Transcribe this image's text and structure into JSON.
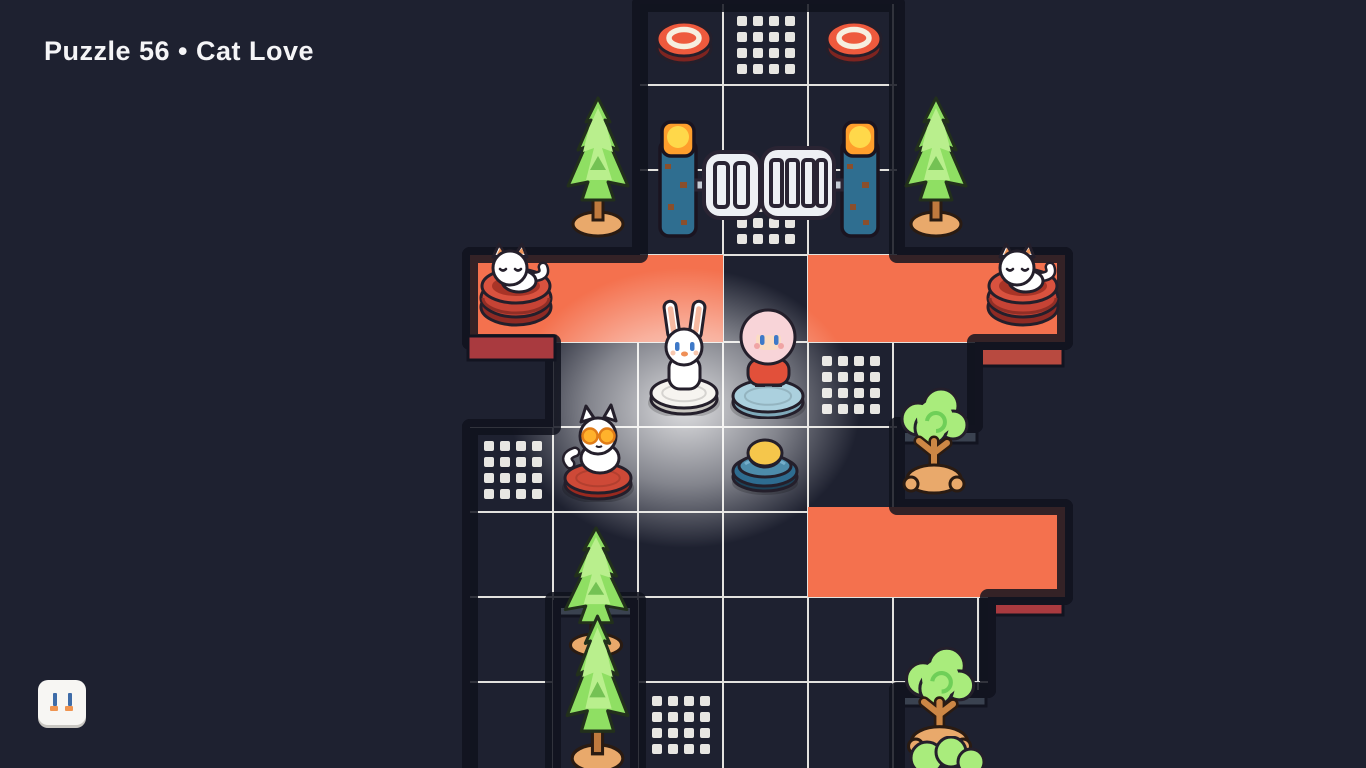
{
  "header": {
    "title": "Puzzle 56 • Cat Love"
  },
  "hud": {
    "pause_button": {
      "icon": "pause-icon"
    }
  },
  "colors": {
    "background": "#1e2130",
    "title_text": "#f5f5f7",
    "floor": "#f1f0ee",
    "floor_grid_line": "#e3e2de",
    "floor_dot": "#e7e6e2",
    "carpet_orange": "#f4714e",
    "carpet_side_red": "#a93a3f",
    "pipe_outline": "#121420",
    "pipe_silver": "#b8bfca",
    "pipe_highlight": "#e6e9ee",
    "under_floor_shade": "#3a4250",
    "glow_white": "#ffffff"
  },
  "board": {
    "carpets": [
      {
        "x": 470,
        "y": 255,
        "w": 253,
        "h": 87
      },
      {
        "x": 808,
        "y": 255,
        "w": 257,
        "h": 87
      },
      {
        "x": 808,
        "y": 507,
        "w": 257,
        "h": 90
      }
    ],
    "dotted_tiles": [
      {
        "x": 723,
        "y": 2
      },
      {
        "x": 723,
        "y": 172
      },
      {
        "x": 808,
        "y": 342
      },
      {
        "x": 470,
        "y": 427
      },
      {
        "x": 638,
        "y": 682
      }
    ]
  },
  "entities": [
    {
      "type": "pressure-plate",
      "name": "red-pressure-plate",
      "x": 653,
      "y": 12,
      "w": 62,
      "h": 56,
      "interactable": false
    },
    {
      "type": "pressure-plate",
      "name": "red-pressure-plate",
      "x": 823,
      "y": 12,
      "w": 62,
      "h": 56,
      "interactable": false
    },
    {
      "type": "pine-tree",
      "name": "pine-tree",
      "x": 556,
      "y": 96,
      "w": 84,
      "h": 142,
      "interactable": false
    },
    {
      "type": "pine-tree",
      "name": "pine-tree",
      "x": 894,
      "y": 96,
      "w": 84,
      "h": 142,
      "interactable": false
    },
    {
      "type": "gate",
      "name": "sliding-gate",
      "x": 658,
      "y": 120,
      "w": 222,
      "h": 122,
      "interactable": false
    },
    {
      "type": "cat-bed",
      "name": "cat-bed-sleeping-cat",
      "x": 471,
      "y": 241,
      "w": 90,
      "h": 94,
      "interactable": false
    },
    {
      "type": "cat-bed",
      "name": "cat-bed-sleeping-cat",
      "x": 978,
      "y": 241,
      "w": 90,
      "h": 94,
      "interactable": false
    },
    {
      "type": "rabbit-vacuum",
      "name": "rabbit-on-vacuum",
      "x": 647,
      "y": 297,
      "w": 75,
      "h": 119,
      "interactable": true
    },
    {
      "type": "girl-vacuum",
      "name": "girl-on-vacuum",
      "x": 729,
      "y": 297,
      "w": 79,
      "h": 122,
      "interactable": true
    },
    {
      "type": "round-tree",
      "name": "round-tree",
      "x": 889,
      "y": 381,
      "w": 89,
      "h": 124,
      "interactable": false
    },
    {
      "type": "cat-vacuum",
      "name": "cat-on-vacuum",
      "x": 555,
      "y": 396,
      "w": 87,
      "h": 106,
      "interactable": true
    },
    {
      "type": "dock",
      "name": "button-vacuum-dock",
      "x": 727,
      "y": 431,
      "w": 77,
      "h": 65,
      "interactable": true
    },
    {
      "type": "pine-tree",
      "name": "pine-tree",
      "x": 553,
      "y": 526,
      "w": 86,
      "h": 132,
      "interactable": false
    },
    {
      "type": "pine-tree",
      "name": "pine-tree",
      "x": 555,
      "y": 614,
      "w": 85,
      "h": 160,
      "interactable": false
    },
    {
      "type": "round-tree",
      "name": "round-tree",
      "x": 893,
      "y": 640,
      "w": 92,
      "h": 128,
      "interactable": false
    },
    {
      "type": "bush",
      "name": "bush",
      "x": 903,
      "y": 736,
      "w": 88,
      "h": 32,
      "interactable": false
    }
  ]
}
